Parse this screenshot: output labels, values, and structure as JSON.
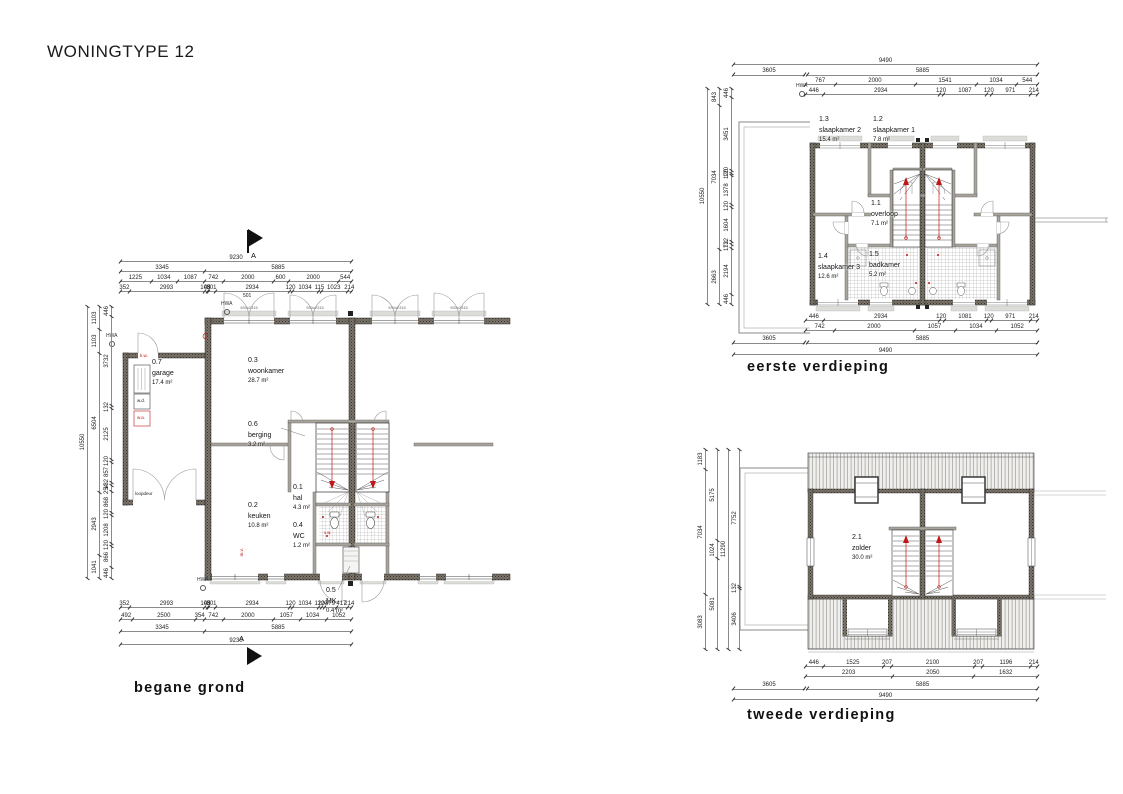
{
  "title": "WONINGTYPE 12",
  "colors": {
    "annotation_red": "#c01818",
    "line_dark": "#1c1c1c",
    "wall_gray": "#7a746a"
  },
  "labels": {
    "hwa": "HWA",
    "section_marker": "A",
    "window_size": "930x2315",
    "loopdeur": "loopdeur",
    "kw": "k.w.",
    "wd": "w.d.",
    "wa": "w.a.",
    "mv": "m.v.",
    "vw": "v.w.",
    "top_extra": "501"
  },
  "plans": {
    "begane_grond": {
      "caption": "begane grond",
      "rooms": [
        {
          "number": "0.7",
          "name": "garage",
          "area": "17.4 m²"
        },
        {
          "number": "0.3",
          "name": "woonkamer",
          "area": "28.7 m²"
        },
        {
          "number": "0.6",
          "name": "berging",
          "area": "3.2 m²"
        },
        {
          "number": "0.2",
          "name": "keuken",
          "area": "10.8 m²"
        },
        {
          "number": "0.1",
          "name": "hal",
          "area": "4.3 m²"
        },
        {
          "number": "0.4",
          "name": "WC",
          "area": "1.2 m²"
        },
        {
          "number": "0.5",
          "name": "MK",
          "area": "0.4 m²"
        }
      ],
      "dims": {
        "top": [
          [
            "9230"
          ],
          [
            "3345",
            "5885"
          ],
          [
            "1225",
            "1034",
            "1087",
            "742",
            "2000",
            "600",
            "2000",
            "544"
          ],
          [
            "352",
            "2993",
            "100",
            "45",
            "301",
            "2934",
            "120",
            "1034",
            "115",
            "1023",
            "214"
          ]
        ],
        "bottom": [
          [
            "352",
            "2993",
            "100",
            "45",
            "301",
            "2934",
            "120",
            "1034",
            "120",
            "120",
            "479",
            "417",
            "214"
          ],
          [
            "492",
            "2500",
            "354",
            "742",
            "2000",
            "1057",
            "1034",
            "1052"
          ],
          [
            "3345",
            "5885"
          ],
          [
            "9230"
          ]
        ],
        "left": [
          [
            "10550"
          ],
          [
            "1103",
            "1103",
            "6504",
            "2943",
            "1041"
          ],
          [
            "446",
            "3732",
            "132",
            "2125",
            "120",
            "857",
            "132",
            "254",
            "868",
            "120",
            "1208",
            "120",
            "866",
            "446"
          ]
        ]
      }
    },
    "eerste_verdieping": {
      "caption": "eerste verdieping",
      "rooms": [
        {
          "number": "1.3",
          "name": "slaapkamer 2",
          "area": "15.4 m²"
        },
        {
          "number": "1.2",
          "name": "slaapkamer 1",
          "area": "7.8 m²"
        },
        {
          "number": "1.1",
          "name": "overloop",
          "area": "7.1 m²"
        },
        {
          "number": "1.4",
          "name": "slaapkamer 3",
          "area": "12.6 m²"
        },
        {
          "number": "1.5",
          "name": "badkamer",
          "area": "5.2 m²"
        }
      ],
      "dims": {
        "top": [
          [
            "9490"
          ],
          [
            "3605",
            "5885"
          ],
          [
            "767",
            "2000",
            "1541",
            "1034",
            "544"
          ],
          [
            "446",
            "2934",
            "120",
            "1087",
            "120",
            "971",
            "214"
          ]
        ],
        "bottom": [
          [
            "446",
            "2934",
            "120",
            "1081",
            "120",
            "971",
            "214"
          ],
          [
            "742",
            "2000",
            "1057",
            "1034",
            "1052"
          ],
          [
            "3605",
            "5885"
          ],
          [
            "9490"
          ]
        ],
        "left": [
          [
            "10550"
          ],
          [
            "843",
            "7034",
            "2663"
          ],
          [
            "446",
            "3451",
            "120",
            "120",
            "1378",
            "120",
            "1604",
            "132",
            "172",
            "2194",
            "446"
          ]
        ]
      }
    },
    "tweede_verdieping": {
      "caption": "tweede verdieping",
      "rooms": [
        {
          "number": "2.1",
          "name": "zolder",
          "area": "30.0 m²"
        }
      ],
      "dims": {
        "bottom": [
          [
            "446",
            "1525",
            "207",
            "2100",
            "207",
            "1196",
            "214"
          ],
          [
            "2203",
            "2050",
            "1632"
          ],
          [
            "3605",
            "5885"
          ],
          [
            "9490"
          ]
        ],
        "left": [
          [
            "1183",
            "7034",
            "3083"
          ],
          [
            "5175",
            "1024",
            "5081"
          ],
          [
            "11290"
          ],
          [
            "7752",
            "132",
            "3406"
          ]
        ]
      }
    }
  }
}
